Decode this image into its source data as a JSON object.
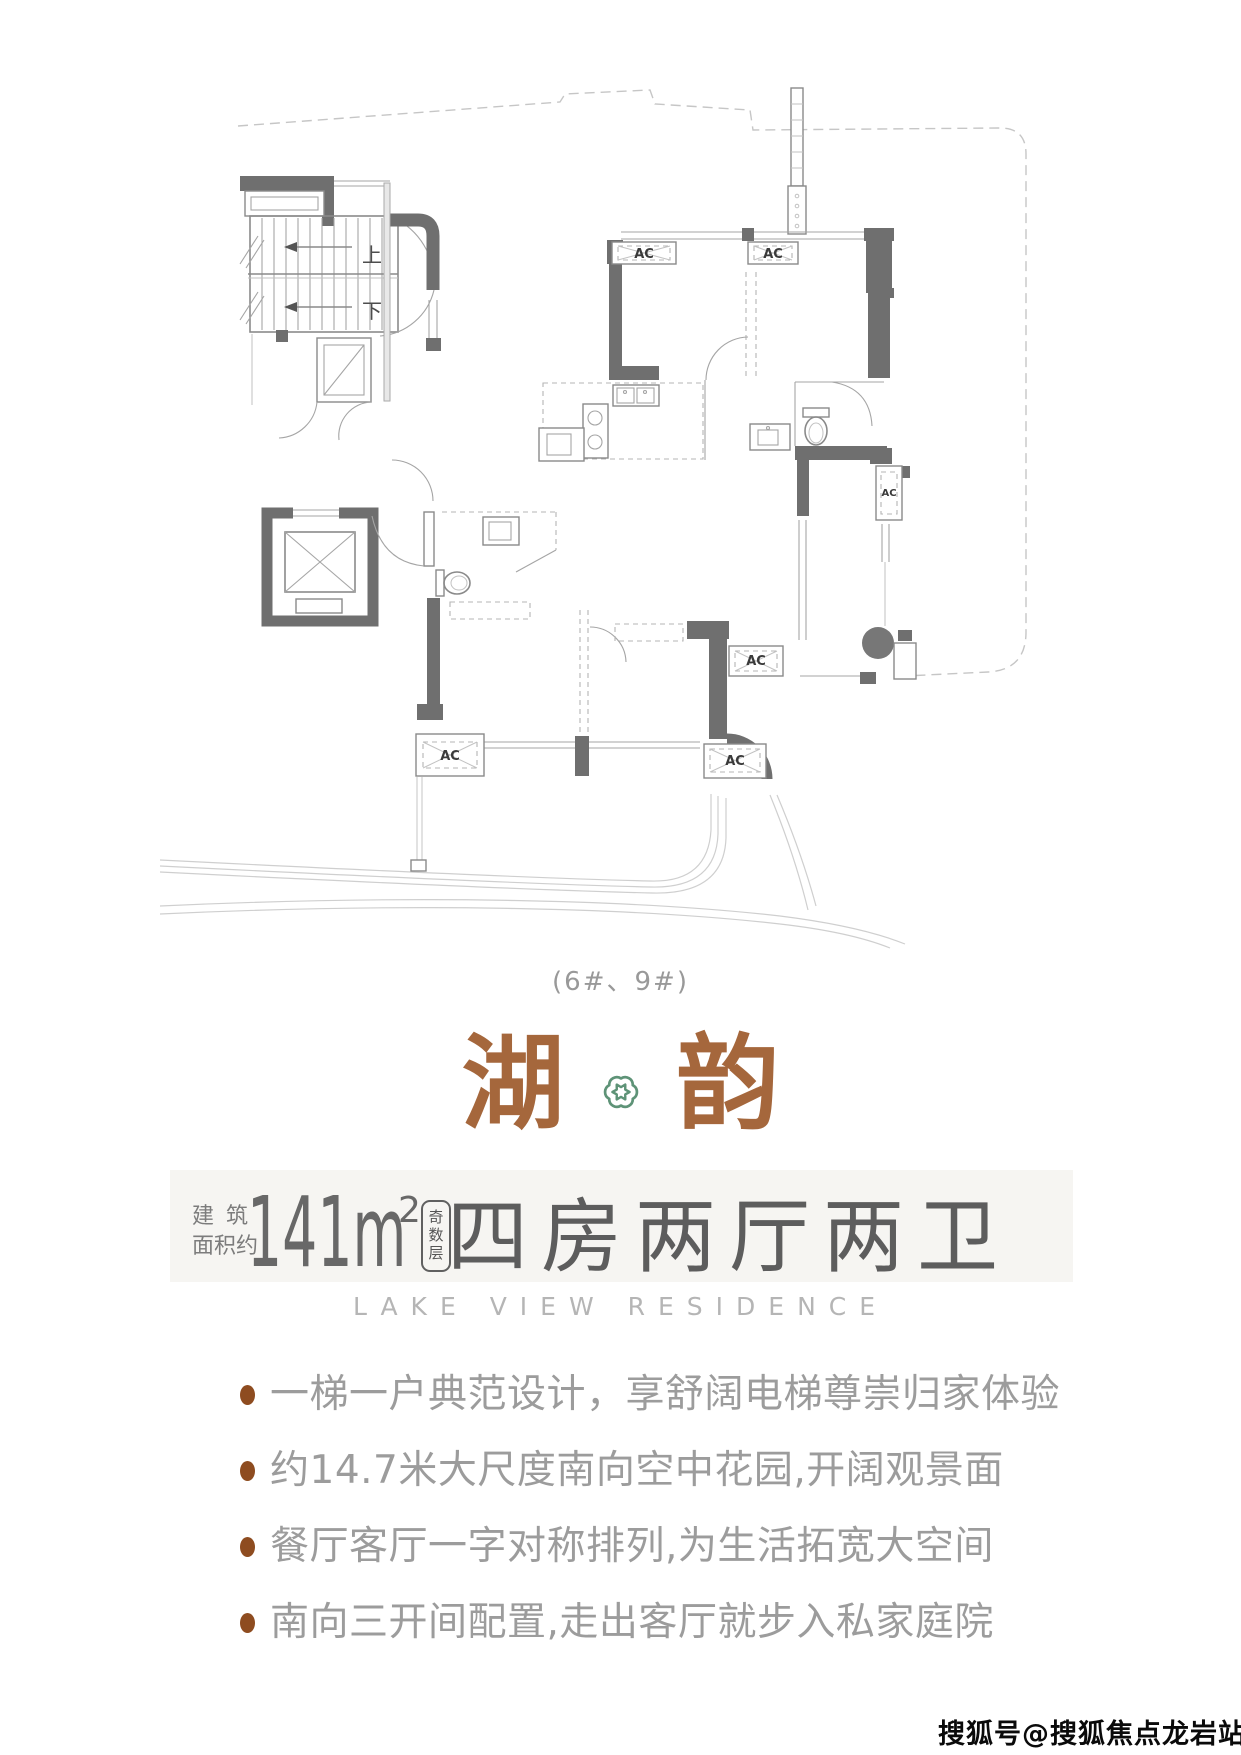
{
  "floor_plan": {
    "ac_label": "AC",
    "up_label": "上",
    "down_label": "下",
    "building_note": "(6#、9#)"
  },
  "title": {
    "left_char": "湖",
    "right_char": "韵",
    "text_color": "#A5673C",
    "icon": "flower-icon",
    "icon_color": "#5E9377"
  },
  "spec": {
    "prefix_line1": "建筑",
    "prefix_line2": "面积约",
    "area_number": "141m",
    "area_sup": "2",
    "badge_vertical": "奇数层",
    "layout_text": "四房两厅两卫",
    "subtitle_en": "LAKE VIEW RESIDENCE",
    "band_color": "#f6f5f2"
  },
  "features": {
    "bullet_color": "#8E4C20",
    "items": [
      "一梯一户典范设计，享舒阔电梯尊崇归家体验",
      "约14.7米大尺度南向空中花园,开阔观景面",
      "餐厅客厅一字对称排列,为生活拓宽大空间",
      "南向三开间配置,走出客厅就步入私家庭院"
    ]
  },
  "watermark": {
    "text": "搜狐号@搜狐焦点龙岩站"
  }
}
